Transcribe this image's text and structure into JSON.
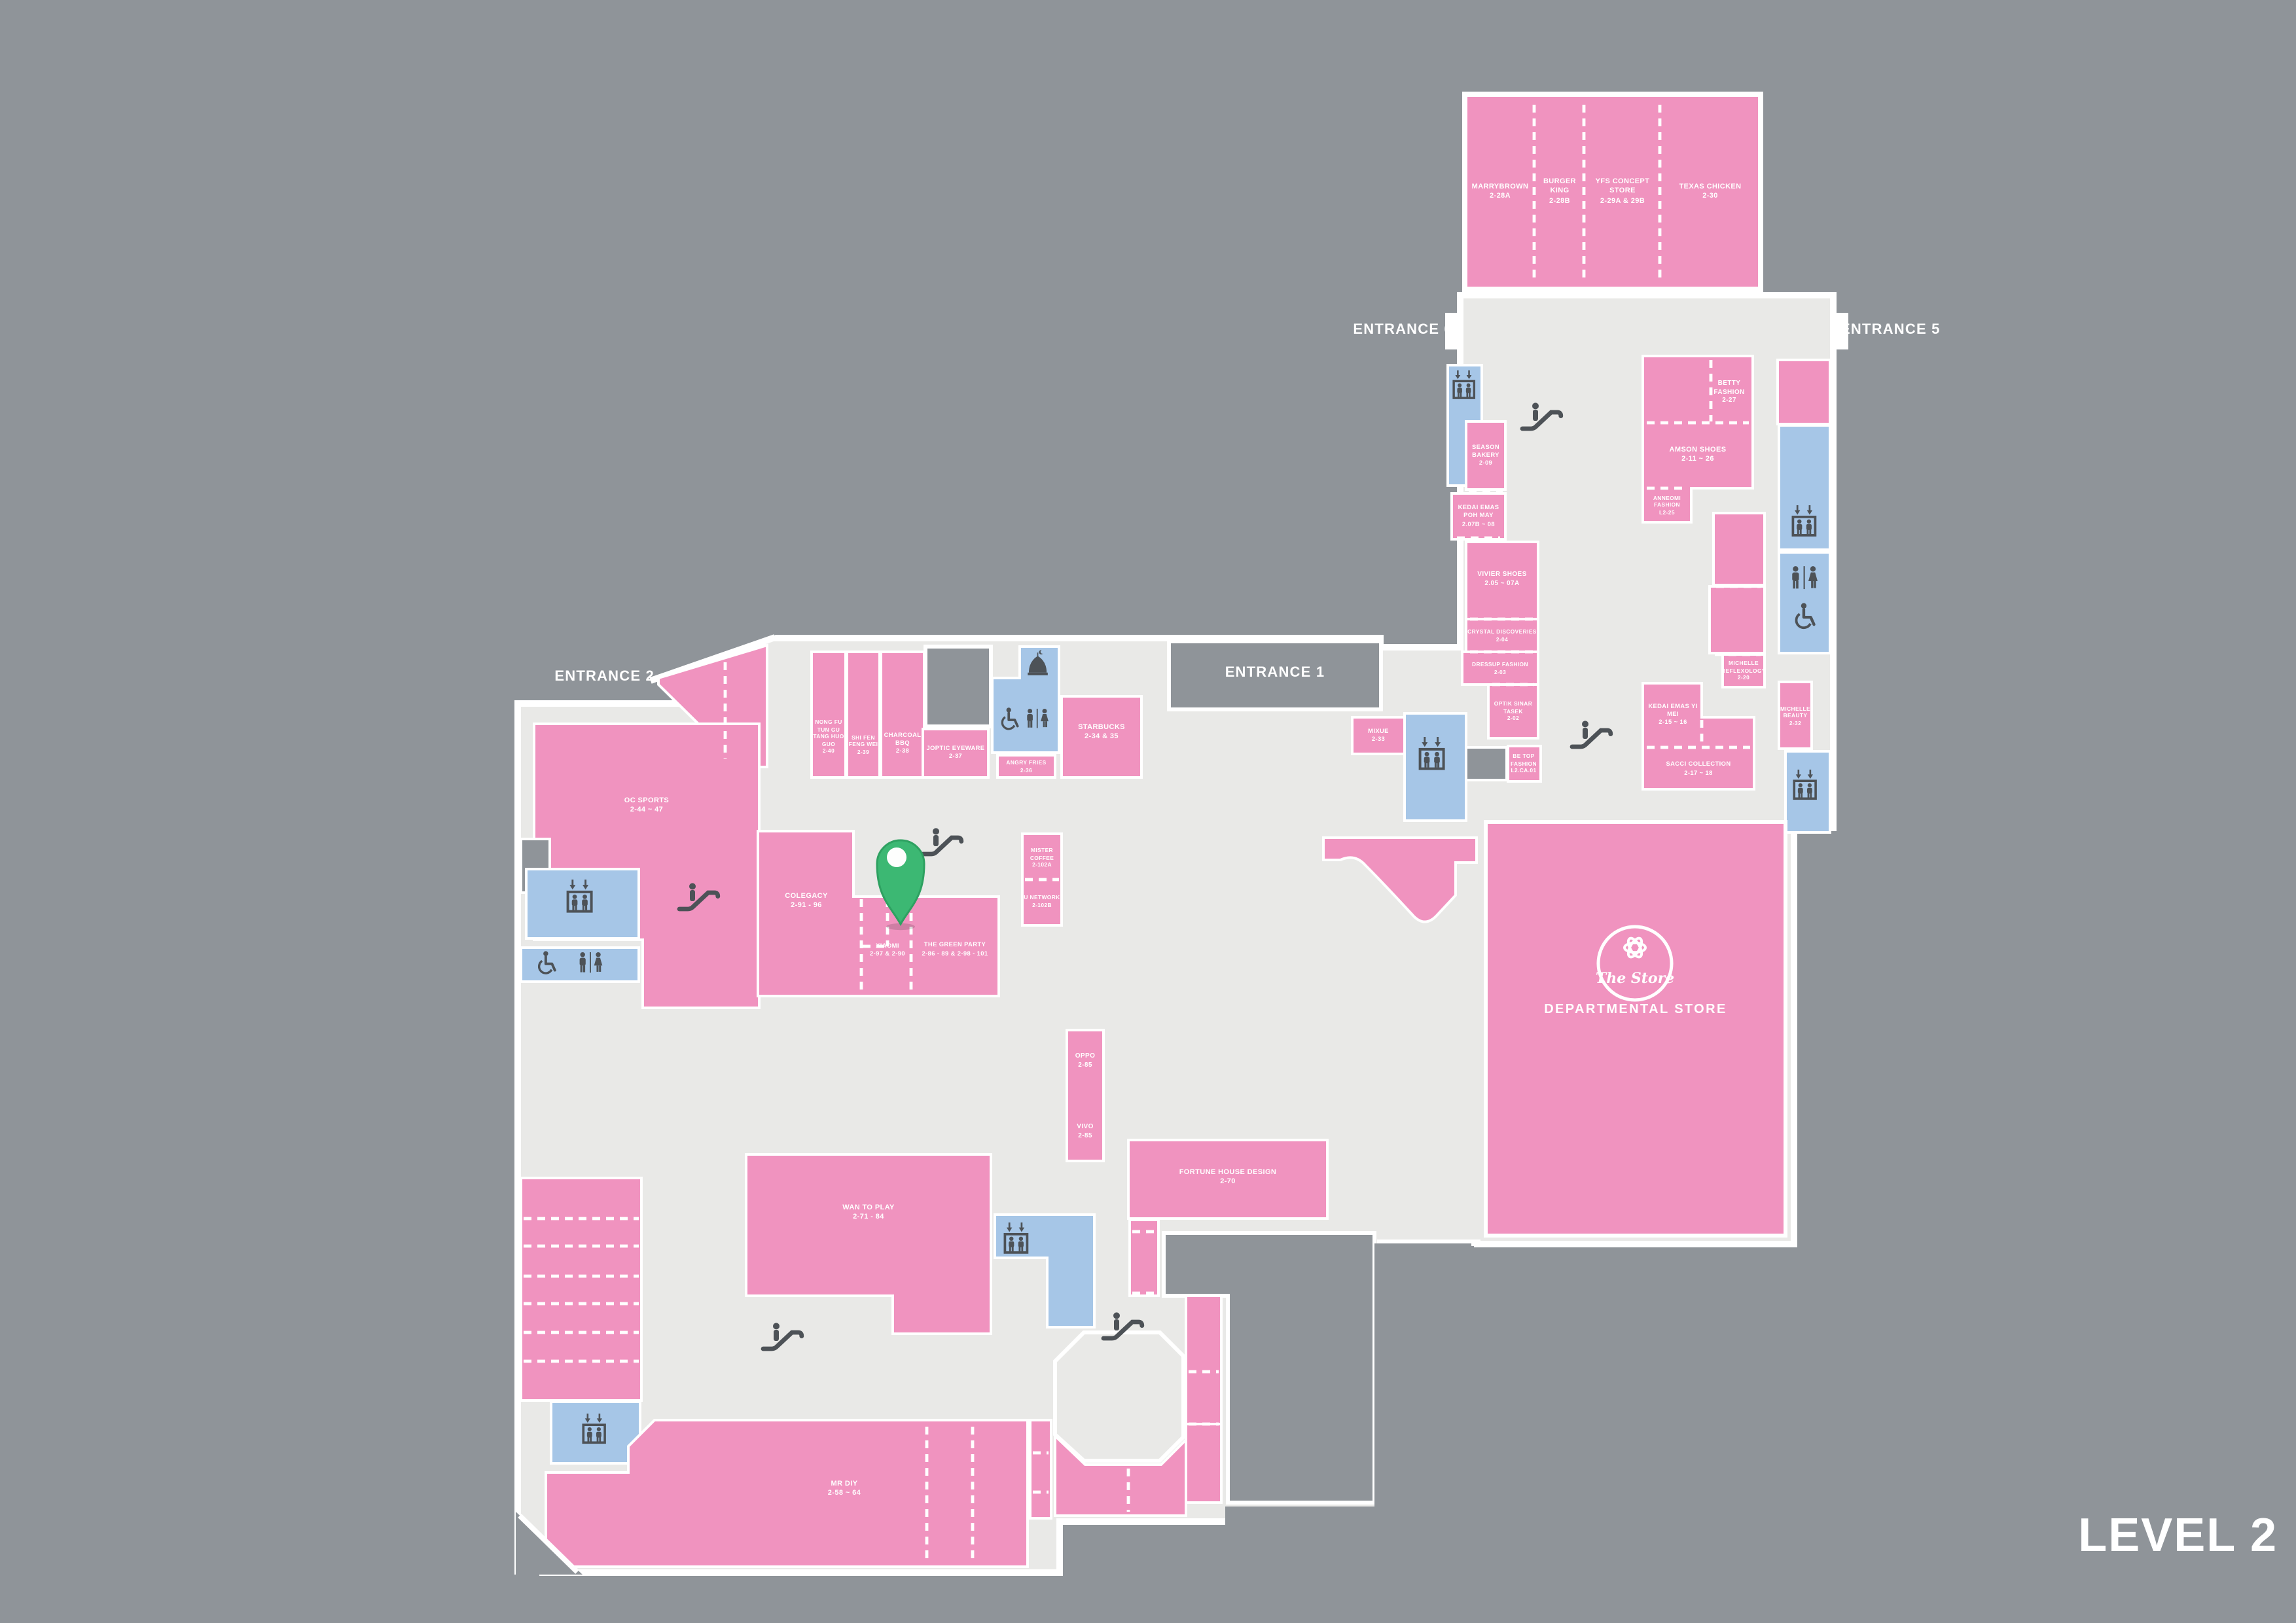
{
  "map": {
    "level_label": "LEVEL 2",
    "entrances": {
      "e1": "ENTRANCE 1",
      "e2": "ENTRANCE 2",
      "e5": "ENTRANCE 5",
      "e6": "ENTRANCE 6"
    },
    "departmental_store": {
      "logo": "The Store",
      "label": "DEPARTMENTAL STORE"
    },
    "colors": {
      "background": "#8f9499",
      "floor": "#e9e9e7",
      "store_pink": "#f093bf",
      "facility_blue": "#a6c6e7",
      "icon_dark": "#4d5257",
      "pin_green": "#3cb873",
      "border_white": "#ffffff"
    },
    "facility_icons": [
      "lift-icon",
      "toilet-icon",
      "accessible-toilet-icon",
      "escalator-icon",
      "surau-icon",
      "location-pin-icon"
    ],
    "stores": [
      {
        "name": "MARRYBROWN",
        "unit": "2-28A"
      },
      {
        "name": "BURGER KING",
        "unit": "2-28B"
      },
      {
        "name": "YFS CONCEPT STORE",
        "unit": "2-29A & 29B"
      },
      {
        "name": "TEXAS CHICKEN",
        "unit": "2-30"
      },
      {
        "name": "SEASON BAKERY",
        "unit": "2-09"
      },
      {
        "name": "KEDAI EMAS POH MAY",
        "unit": "2.07B ~ 08"
      },
      {
        "name": "VIVIER SHOES",
        "unit": "2.05 ~ 07A"
      },
      {
        "name": "CRYSTAL DISCOVERIES",
        "unit": "2-04"
      },
      {
        "name": "DRESSUP FASHION",
        "unit": "2-03"
      },
      {
        "name": "OPTIK SINAR TASEK",
        "unit": "2-02"
      },
      {
        "name": "BE TOP FASHION",
        "unit": "L2.CA.01"
      },
      {
        "name": "BETTY FASHION",
        "unit": "2-27"
      },
      {
        "name": "AMSON SHOES",
        "unit": "2-11 ~ 26"
      },
      {
        "name": "ANNEOMI FASHION",
        "unit": "L2-25"
      },
      {
        "name": "MICHELLE REFLEXOLOGY",
        "unit": "2-20"
      },
      {
        "name": "KEDAI EMAS YI MEI",
        "unit": "2-15 ~ 16"
      },
      {
        "name": "SACCI COLLECTION",
        "unit": "2-17 ~ 18"
      },
      {
        "name": "MICHELLE BEAUTY",
        "unit": "2-32"
      },
      {
        "name": "MIXUE",
        "unit": "2-33"
      },
      {
        "name": "NONG FU TUN GU TANG HUO GUO",
        "unit": "2-40"
      },
      {
        "name": "SHI FEN FENG WEI",
        "unit": "2-39"
      },
      {
        "name": "CHARCOAL BBQ",
        "unit": "2-38"
      },
      {
        "name": "JOPTIC EYEWARE",
        "unit": "2-37"
      },
      {
        "name": "ANGRY FRIES",
        "unit": "2-36"
      },
      {
        "name": "STARBUCKS",
        "unit": "2-34 & 35"
      },
      {
        "name": "OC SPORTS",
        "unit": "2-44 ~ 47"
      },
      {
        "name": "COLEGACY",
        "unit": "2-91 - 96"
      },
      {
        "name": "XIAOMI",
        "unit": "2-97 & 2-90"
      },
      {
        "name": "THE GREEN PARTY",
        "unit": "2-86 - 89 & 2-98 - 101"
      },
      {
        "name": "MISTER COFFEE",
        "unit": "2-102A"
      },
      {
        "name": "U NETWORK",
        "unit": "2-102B"
      },
      {
        "name": "OPPO",
        "unit": "2-85"
      },
      {
        "name": "VIVO",
        "unit": "2-85"
      },
      {
        "name": "FORTUNE HOUSE DESIGN",
        "unit": "2-70"
      },
      {
        "name": "WAN TO PLAY",
        "unit": "2-71 - 84"
      },
      {
        "name": "MR DIY",
        "unit": "2-58 ~ 64"
      }
    ]
  }
}
